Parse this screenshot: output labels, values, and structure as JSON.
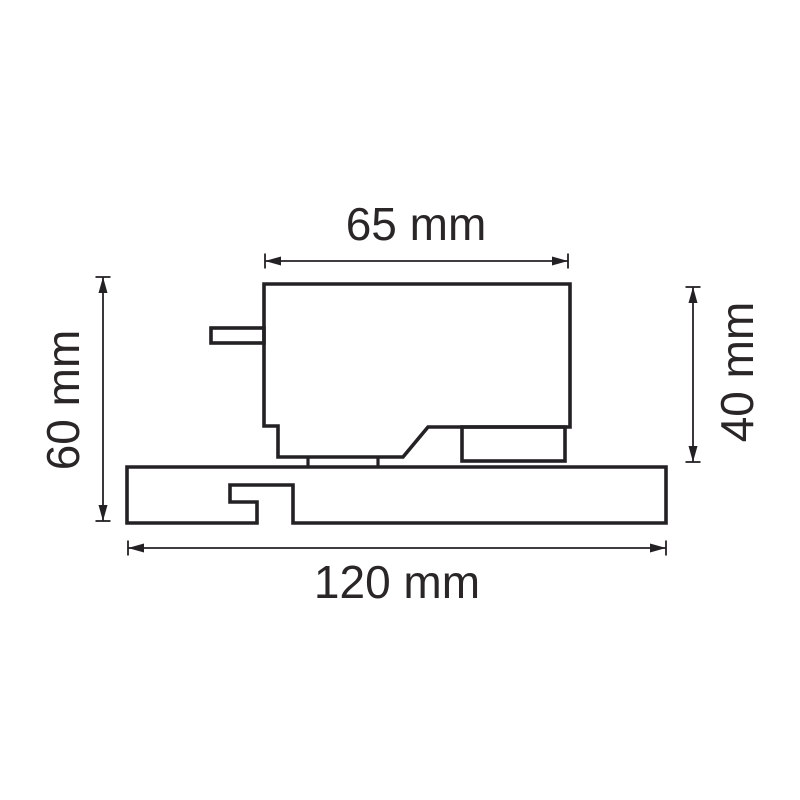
{
  "drawing": {
    "background": "#ffffff",
    "stroke_color": "#242124",
    "units": "mm",
    "labels": {
      "top_width": "65 mm",
      "left_height": "60 mm",
      "right_height": "40 mm",
      "bottom_width": "120 mm"
    },
    "dimensions": {
      "top_width_mm": 65,
      "left_height_mm": 60,
      "right_height_mm": 40,
      "bottom_width_mm": 120
    },
    "shapes": [
      {
        "name": "adapter-body-outline",
        "type": "path",
        "d": "M264,284 L570,284 L570,427 L428,427 L403,457 L278,457 L278,426 L264,426 Z"
      },
      {
        "name": "side-tab-outline",
        "type": "rect",
        "x": 211,
        "y": 328,
        "w": 53,
        "h": 15
      },
      {
        "name": "bottom-right-block-outline",
        "type": "rect",
        "x": 462,
        "y": 427,
        "w": 103,
        "h": 34
      },
      {
        "name": "foot-tick-left",
        "type": "line",
        "x1": 308,
        "y1": 457,
        "x2": 308,
        "y2": 467
      },
      {
        "name": "foot-tick-right",
        "type": "line",
        "x1": 378,
        "y1": 457,
        "x2": 378,
        "y2": 467
      },
      {
        "name": "track-profile-outline",
        "type": "path",
        "d": "M127,467 L666,467 L666,523 L293,523 L293,485 L230,485 L230,502 L257,502 L257,523 L127,523 Z"
      }
    ],
    "dimension_lines": [
      {
        "name": "dim-line-top-width",
        "orientation": "h",
        "x1": 265,
        "x2": 568,
        "y": 261
      },
      {
        "name": "dim-line-bottom-width",
        "orientation": "h",
        "x1": 128,
        "x2": 666,
        "y": 548
      },
      {
        "name": "dim-line-left-height",
        "orientation": "v",
        "y1": 277,
        "y2": 521,
        "x": 103
      },
      {
        "name": "dim-line-right-height",
        "orientation": "v",
        "y1": 287,
        "y2": 462,
        "x": 693
      }
    ]
  }
}
